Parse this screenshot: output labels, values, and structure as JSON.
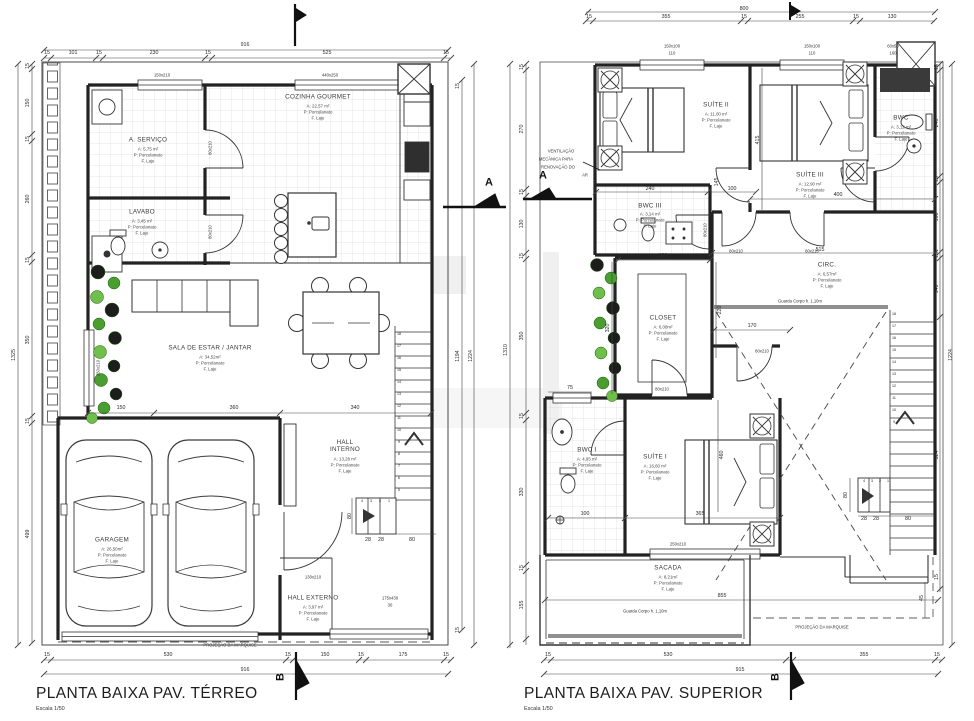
{
  "left": {
    "title": "PLANTA BAIXA PAV. TÉRREO",
    "scale": "Escala 1/50",
    "rooms": [
      {
        "name": "A. SERVIÇO",
        "area": "A: 5,75 m²",
        "floor": "P: Porcelanato",
        "slab": "F. Laje"
      },
      {
        "name": "COZINHA GOURMET",
        "area": "A: 22,57 m²",
        "floor": "P: Porcelanato",
        "slab": "F. Laje"
      },
      {
        "name": "LAVABO",
        "area": "A: 3,45 m²",
        "floor": "P: Porcelanato",
        "slab": "F. Laje"
      },
      {
        "name": "SALA DE ESTAR / JANTAR",
        "area": "A: 34,52m²",
        "floor": "P: Porcelanato",
        "slab": "F. Laje"
      },
      {
        "name": "GARAGEM",
        "area": "A: 26,50m²",
        "floor": "P: Porcelanato",
        "slab": "F. Laje"
      },
      {
        "name": "HALL INTERNO",
        "area": "A: 13,28 m²",
        "floor": "P: Porcelanato",
        "slab": "F. Laje"
      },
      {
        "name": "HALL EXTERNO",
        "area": "A: 3,97 m²",
        "floor": "P: Porcelanato",
        "slab": "F. Laje"
      }
    ],
    "dims": {
      "top_total": "916",
      "top": [
        "15",
        "101",
        "15",
        "230",
        "15",
        "525",
        "15"
      ],
      "left_total": "1325",
      "left": [
        "15",
        "150",
        "15",
        "260",
        "15",
        "350",
        "15",
        "499"
      ],
      "right_total": "1224",
      "right": [
        "15",
        "1194",
        "15"
      ],
      "bottom_total": "916",
      "bottom": [
        "15",
        "530",
        "15",
        "150",
        "15",
        "175",
        "15"
      ],
      "sala": [
        "150",
        "360",
        "340"
      ],
      "stair_width": "80",
      "stair_run": [
        "28",
        "28",
        "80"
      ]
    },
    "openings": {
      "window_service": "150x210",
      "window_kitchen": "440x250",
      "door_service": "80x210",
      "door_lavabo": "80x210",
      "window_sala": "250x210",
      "door_entry": "130x210",
      "window_hall": "175x430",
      "window_hall_sill": "30"
    },
    "stairs": [
      "18",
      "17",
      "16",
      "15",
      "14",
      "13",
      "12",
      "11",
      "10",
      "9",
      "8",
      "7",
      "6",
      "5"
    ],
    "stairs_lower": [
      "4",
      "3",
      "2",
      "1"
    ],
    "marquise": "PROJEÇÃO DA MARQUISE"
  },
  "right": {
    "title": "PLANTA BAIXA PAV. SUPERIOR",
    "scale": "Escala 1/50",
    "rooms": [
      {
        "name": "SUÍTE II",
        "area": "A: 11,00 m²",
        "floor": "P: Porcelanato",
        "slab": "F. Laje"
      },
      {
        "name": "SUÍTE III",
        "area": "A: 12,90 m²",
        "floor": "P: Porcelanato",
        "slab": "F. Laje"
      },
      {
        "name": "BWC",
        "area": "A: 3,12 m²",
        "floor": "P: Porcelanato",
        "slab": "F. Laje"
      },
      {
        "name": "BWC III",
        "area": "A: 3,14 m²",
        "floor": "P: Porcelanato",
        "slab": "F. Laje"
      },
      {
        "name": "CLOSET",
        "area": "A: 6,08m²",
        "floor": "P: Porcelanato",
        "slab": "F. Laje"
      },
      {
        "name": "CIRC.",
        "area": "A: 6,57m²",
        "floor": "P: Porcelanato",
        "slab": "F. Laje"
      },
      {
        "name": "BWC I",
        "area": "A: 4,95 m²",
        "floor": "P: Porcelanato",
        "slab": "F. Laje"
      },
      {
        "name": "SUÍTE I",
        "area": "A: 16,60 m²",
        "floor": "P: Porcelanato",
        "slab": "F. Laje"
      },
      {
        "name": "SACADA",
        "area": "A: 8,21m²",
        "floor": "P: Porcelanato",
        "slab": "F. Laje"
      }
    ],
    "dims": {
      "top_total": "800",
      "top": [
        "15",
        "355",
        "15",
        "255",
        "15",
        "130"
      ],
      "left_total": "1310",
      "left": [
        "15",
        "270",
        "15",
        "130",
        "15",
        "350",
        "15",
        "330",
        "15",
        "155"
      ],
      "right_total": "1224",
      "right": [
        "15",
        "240",
        "15",
        "160",
        "15",
        "140"
      ],
      "stair_height": "624",
      "marquise_side": "45",
      "sacada_side": "15",
      "sacada_width": "855",
      "bottom_total": "915",
      "bottom": [
        "15",
        "530",
        "355",
        "15"
      ],
      "suite2": [
        "240",
        "100",
        "415"
      ],
      "suite3": [
        "400",
        "515"
      ],
      "closet": [
        "191",
        "320",
        "220",
        "170",
        "145"
      ],
      "suite1": [
        "75",
        "100",
        "365",
        "460"
      ],
      "stair_width": "80",
      "stair_run": [
        "28",
        "28",
        "80"
      ]
    },
    "openings": {
      "window_suite2": "150x100",
      "sill_suite2": "110",
      "window_suite3": "150x100",
      "sill_suite3": "110",
      "window_bwc": "60x50",
      "sill_bwc": "160",
      "door_bwc3": "80x210",
      "door_circ_left": "80x210",
      "door_circ_right": "80x210",
      "door_suite1": "80x210",
      "door_closet": "80x210",
      "door_sacada": "250x210"
    },
    "stairs": [
      "18",
      "17",
      "16",
      "15",
      "14",
      "13",
      "12",
      "11",
      "10",
      "9"
    ],
    "stairs_lower": [
      "4",
      "3",
      "2",
      "1"
    ],
    "vent_note": [
      "VENTILAÇÃO",
      "MECÂNICA PARA",
      "RENOVAÇÃO DO",
      "AR"
    ],
    "guard_circ": "Guarda Corpo h. 1,10m",
    "guard_sacada": "Guarda Corpo h. 1,10m",
    "marquise": "PROJEÇÃO DA MARQUISE"
  },
  "sections": {
    "a": "A",
    "b": "B"
  }
}
